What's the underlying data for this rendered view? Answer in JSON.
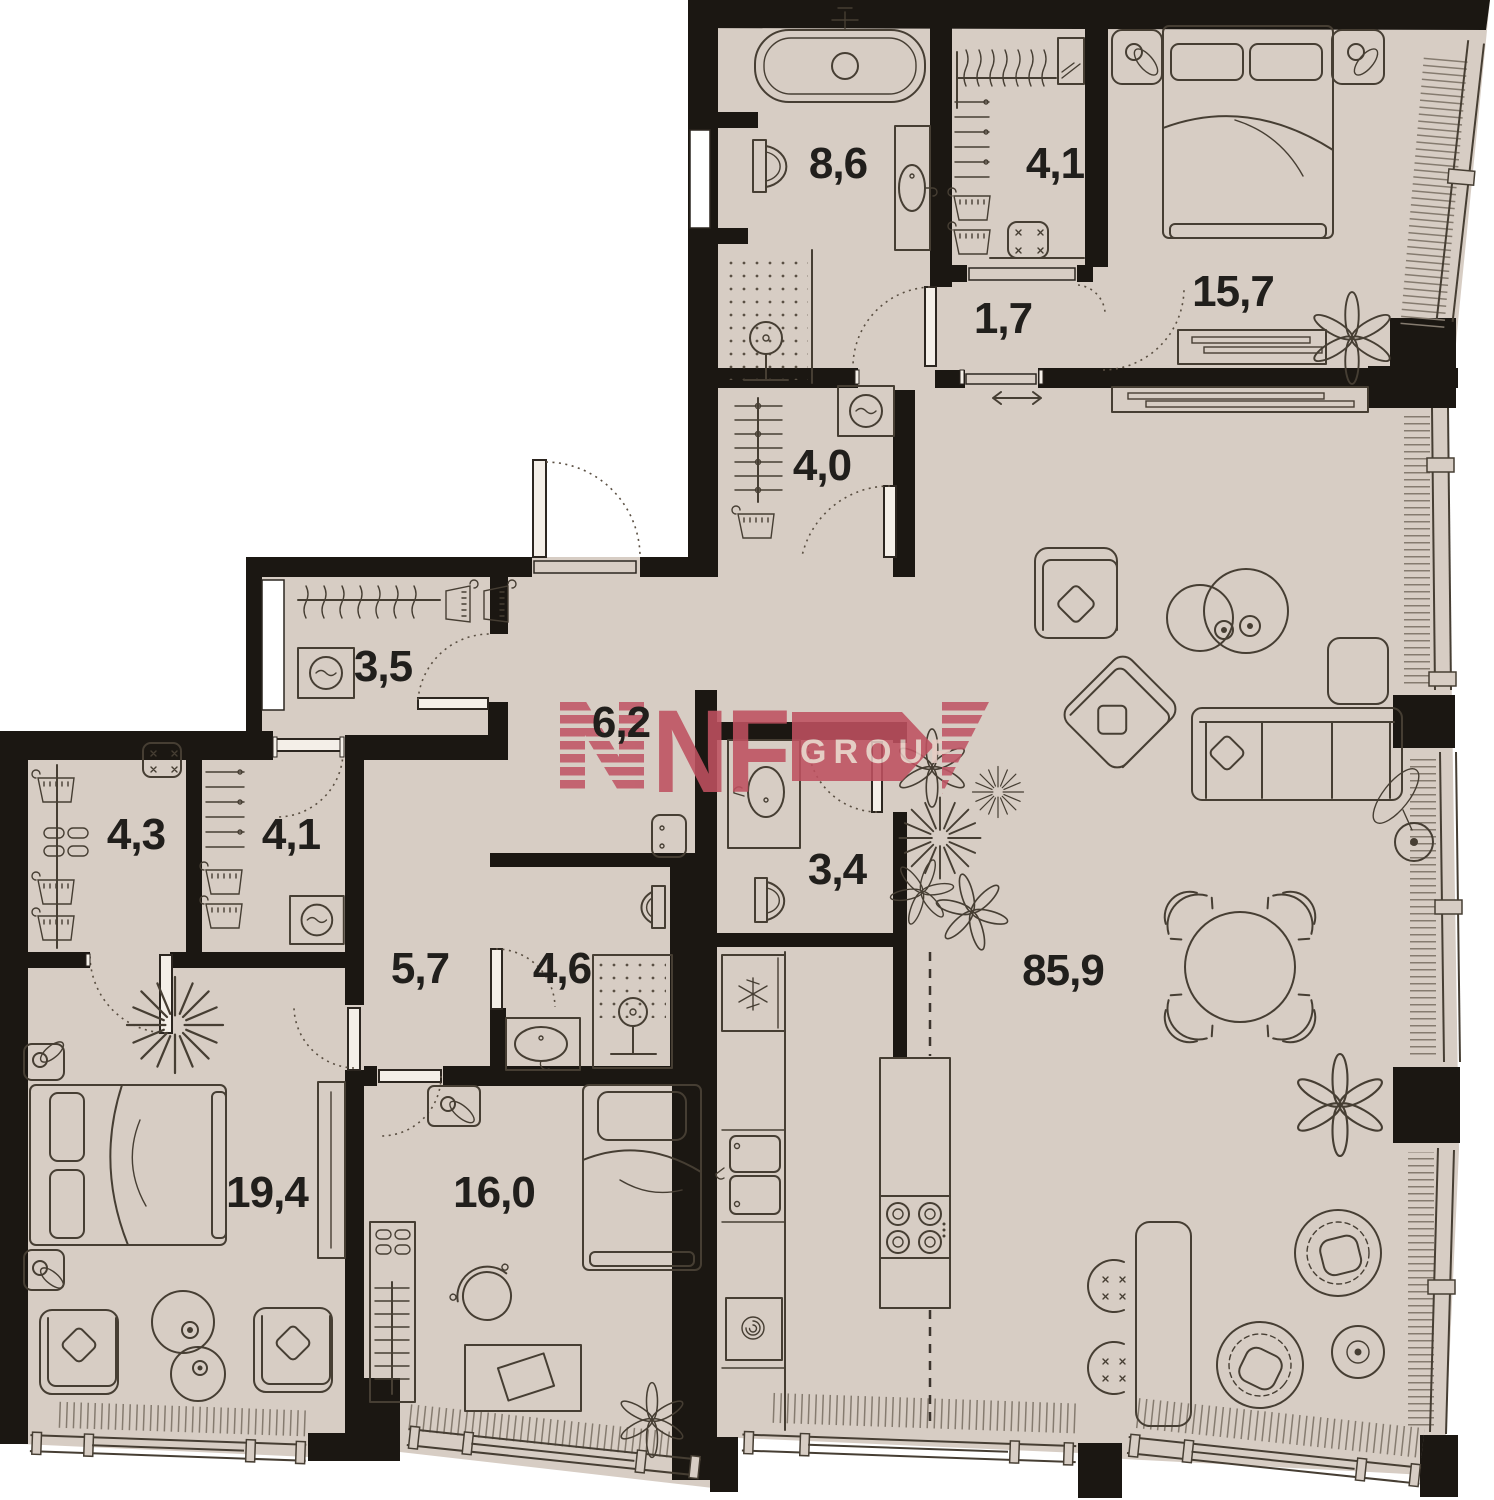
{
  "watermark": {
    "brand": "NF",
    "suffix": "GROUP"
  },
  "colors": {
    "floor": "#d7cdc4",
    "wall": "#1b1712",
    "furniture_line": "#463e33",
    "hatch": "#857b6f",
    "accent_rose": "#c05666",
    "accent_rose_light": "#e7cdc5",
    "label_text": "#211f1c",
    "background": "#ffffff"
  },
  "rooms": [
    {
      "id": "bathroom-master",
      "area": "8,6"
    },
    {
      "id": "wardrobe-top",
      "area": "4,1"
    },
    {
      "id": "bedroom-master",
      "area": "15,7"
    },
    {
      "id": "hall-entry",
      "area": "1,7"
    },
    {
      "id": "laundry",
      "area": "4,0"
    },
    {
      "id": "storage-west",
      "area": "3,5"
    },
    {
      "id": "corridor",
      "area": "6,2"
    },
    {
      "id": "walkin-closet-a",
      "area": "4,3"
    },
    {
      "id": "walkin-closet-b",
      "area": "4,1"
    },
    {
      "id": "hallway-south",
      "area": "5,7"
    },
    {
      "id": "bathroom-second",
      "area": "4,6"
    },
    {
      "id": "bathroom-guest",
      "area": "3,4"
    },
    {
      "id": "living-kitchen",
      "area": "85,9"
    },
    {
      "id": "bedroom-second",
      "area": "19,4"
    },
    {
      "id": "bedroom-third",
      "area": "16,0"
    }
  ]
}
